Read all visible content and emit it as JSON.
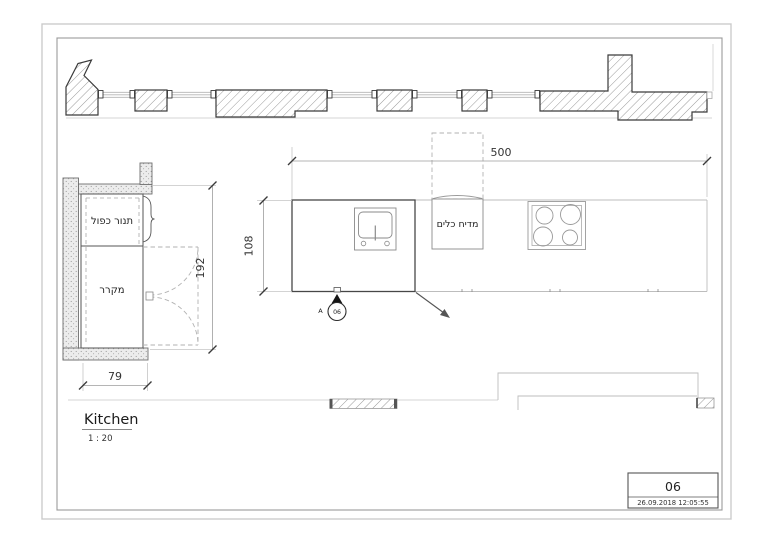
{
  "plan": {
    "title": "Kitchen",
    "scale": "1 : 20",
    "labels": {
      "oven": "תנור כפול",
      "fridge": "מקרר",
      "dishwasher": "מדיח כלים"
    },
    "dimensions": {
      "counter_length": "500",
      "counter_depth": "108",
      "niche_width": "192",
      "wall_thickness": "79"
    },
    "section_marker": {
      "letter": "A",
      "number": "06"
    },
    "title_block": {
      "sheet_number": "06",
      "timestamp": "26.09.2018 12:05:55"
    },
    "colors": {
      "wall_stroke": "#3a3a3a",
      "hatch_line": "#8f8f8f",
      "dimension_line": "#9c9c9c",
      "faint_line": "#d6d6d6",
      "text": "#222222",
      "background": "#ffffff"
    }
  }
}
